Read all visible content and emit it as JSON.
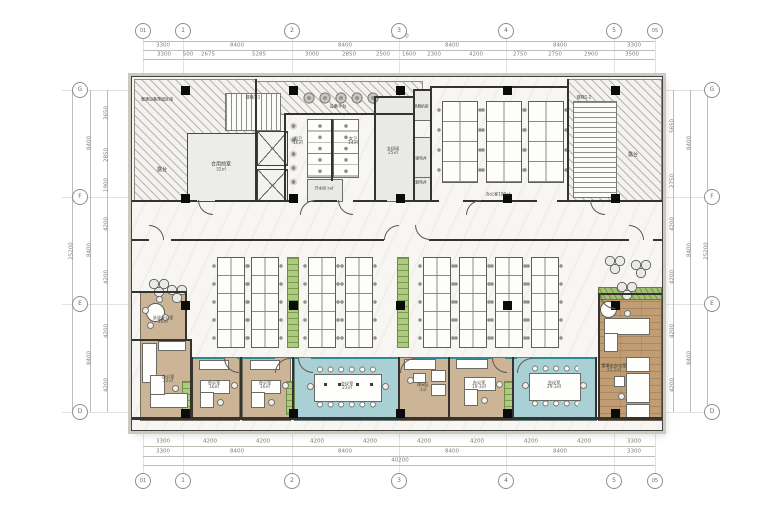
{
  "meta": {
    "drawing_type": "office floor plan (CAD presentation plan)"
  },
  "colors": {
    "teal_room": "#a9d0d4",
    "tan_room": "#cbb596",
    "wood_floor": "#c19d74",
    "green_cabinet": "#accb7f",
    "planter_green": "#a2bf74",
    "wall": "#34332f",
    "teal_partition": "#2e8a90",
    "column": "#0b0b0b",
    "dim_text": "#7c7c78",
    "paper": "#ffffff"
  },
  "grid": {
    "cols": [
      "01",
      "1",
      "2",
      "3",
      "4",
      "5",
      "05"
    ],
    "rows": [
      "G",
      "F",
      "E",
      "D"
    ]
  },
  "dims": {
    "top_total": "40200",
    "top_major": [
      "3300",
      "8400",
      "8400",
      "8400",
      "8400",
      "3300"
    ],
    "top_minor": [
      "3300",
      "500",
      "2675",
      "5285",
      "3000",
      "2850",
      "2500",
      "1600",
      "2300",
      "4200",
      "2750",
      "2750",
      "2900",
      "3500"
    ],
    "bottom_minor": [
      "3300",
      "4200",
      "4200",
      "4200",
      "4200",
      "4200",
      "4200",
      "4200",
      "4200",
      "3300"
    ],
    "bottom_major": [
      "3300",
      "8400",
      "8400",
      "8400",
      "8400",
      "3300"
    ],
    "bottom_total": "40200",
    "left_minor": [
      "3650",
      "2850",
      "1900",
      "4200",
      "4200",
      "4200",
      "4200"
    ],
    "left_major": [
      "8400",
      "8400",
      "8400"
    ],
    "left_total": "25200",
    "right_minor": [
      "5650",
      "2750",
      "4200",
      "4200",
      "4200",
      "4200"
    ],
    "right_major": [
      "8400",
      "8400",
      "8400"
    ],
    "right_total": "25200"
  },
  "rooms": {
    "hvac_note": {
      "name": "暖通设备预留区域"
    },
    "terrace_left": {
      "name": "露台"
    },
    "terrace_right": {
      "name": "露台"
    },
    "stair1": {
      "name": "楼梯1-1"
    },
    "stair2": {
      "name": "楼梯1-2"
    },
    "shared_lobby": {
      "name": "合用前室",
      "area": "32㎡"
    },
    "equip_platform": {
      "name": "设备平台"
    },
    "male_wc": {
      "name": "男卫",
      "area": "16㎡"
    },
    "female_wc": {
      "name": "女卫",
      "area": "14㎡"
    },
    "hot_water": {
      "name": "开水间",
      "area": "5㎡"
    },
    "print_room": {
      "name": "文印间",
      "area": "25㎡"
    },
    "smoke_room": {
      "name": "排烟机房"
    },
    "power_shaft": {
      "name": "强电井"
    },
    "elv_shaft": {
      "name": "弱电井"
    },
    "office_top": {
      "name": "办公室",
      "area": "109㎡"
    },
    "meeting_office": {
      "name": "洽谈办公室",
      "area": "16㎡"
    },
    "office_22": {
      "name": "办公室",
      "area": "22㎡"
    },
    "office_a": {
      "name": "办公室",
      "area": "16㎡"
    },
    "office_b": {
      "name": "办公室",
      "area": "16㎡"
    },
    "conf_1": {
      "name": "会议室",
      "area": "23㎡"
    },
    "lounge": {
      "name": "休闲区",
      "area": "3㎡"
    },
    "office_c": {
      "name": "办公室",
      "area": "19.3㎡"
    },
    "conf_2": {
      "name": "会议室",
      "area": "29.3㎡"
    },
    "exec_office": {
      "name": "董事长办公室",
      "area": "45.5㎡"
    }
  }
}
